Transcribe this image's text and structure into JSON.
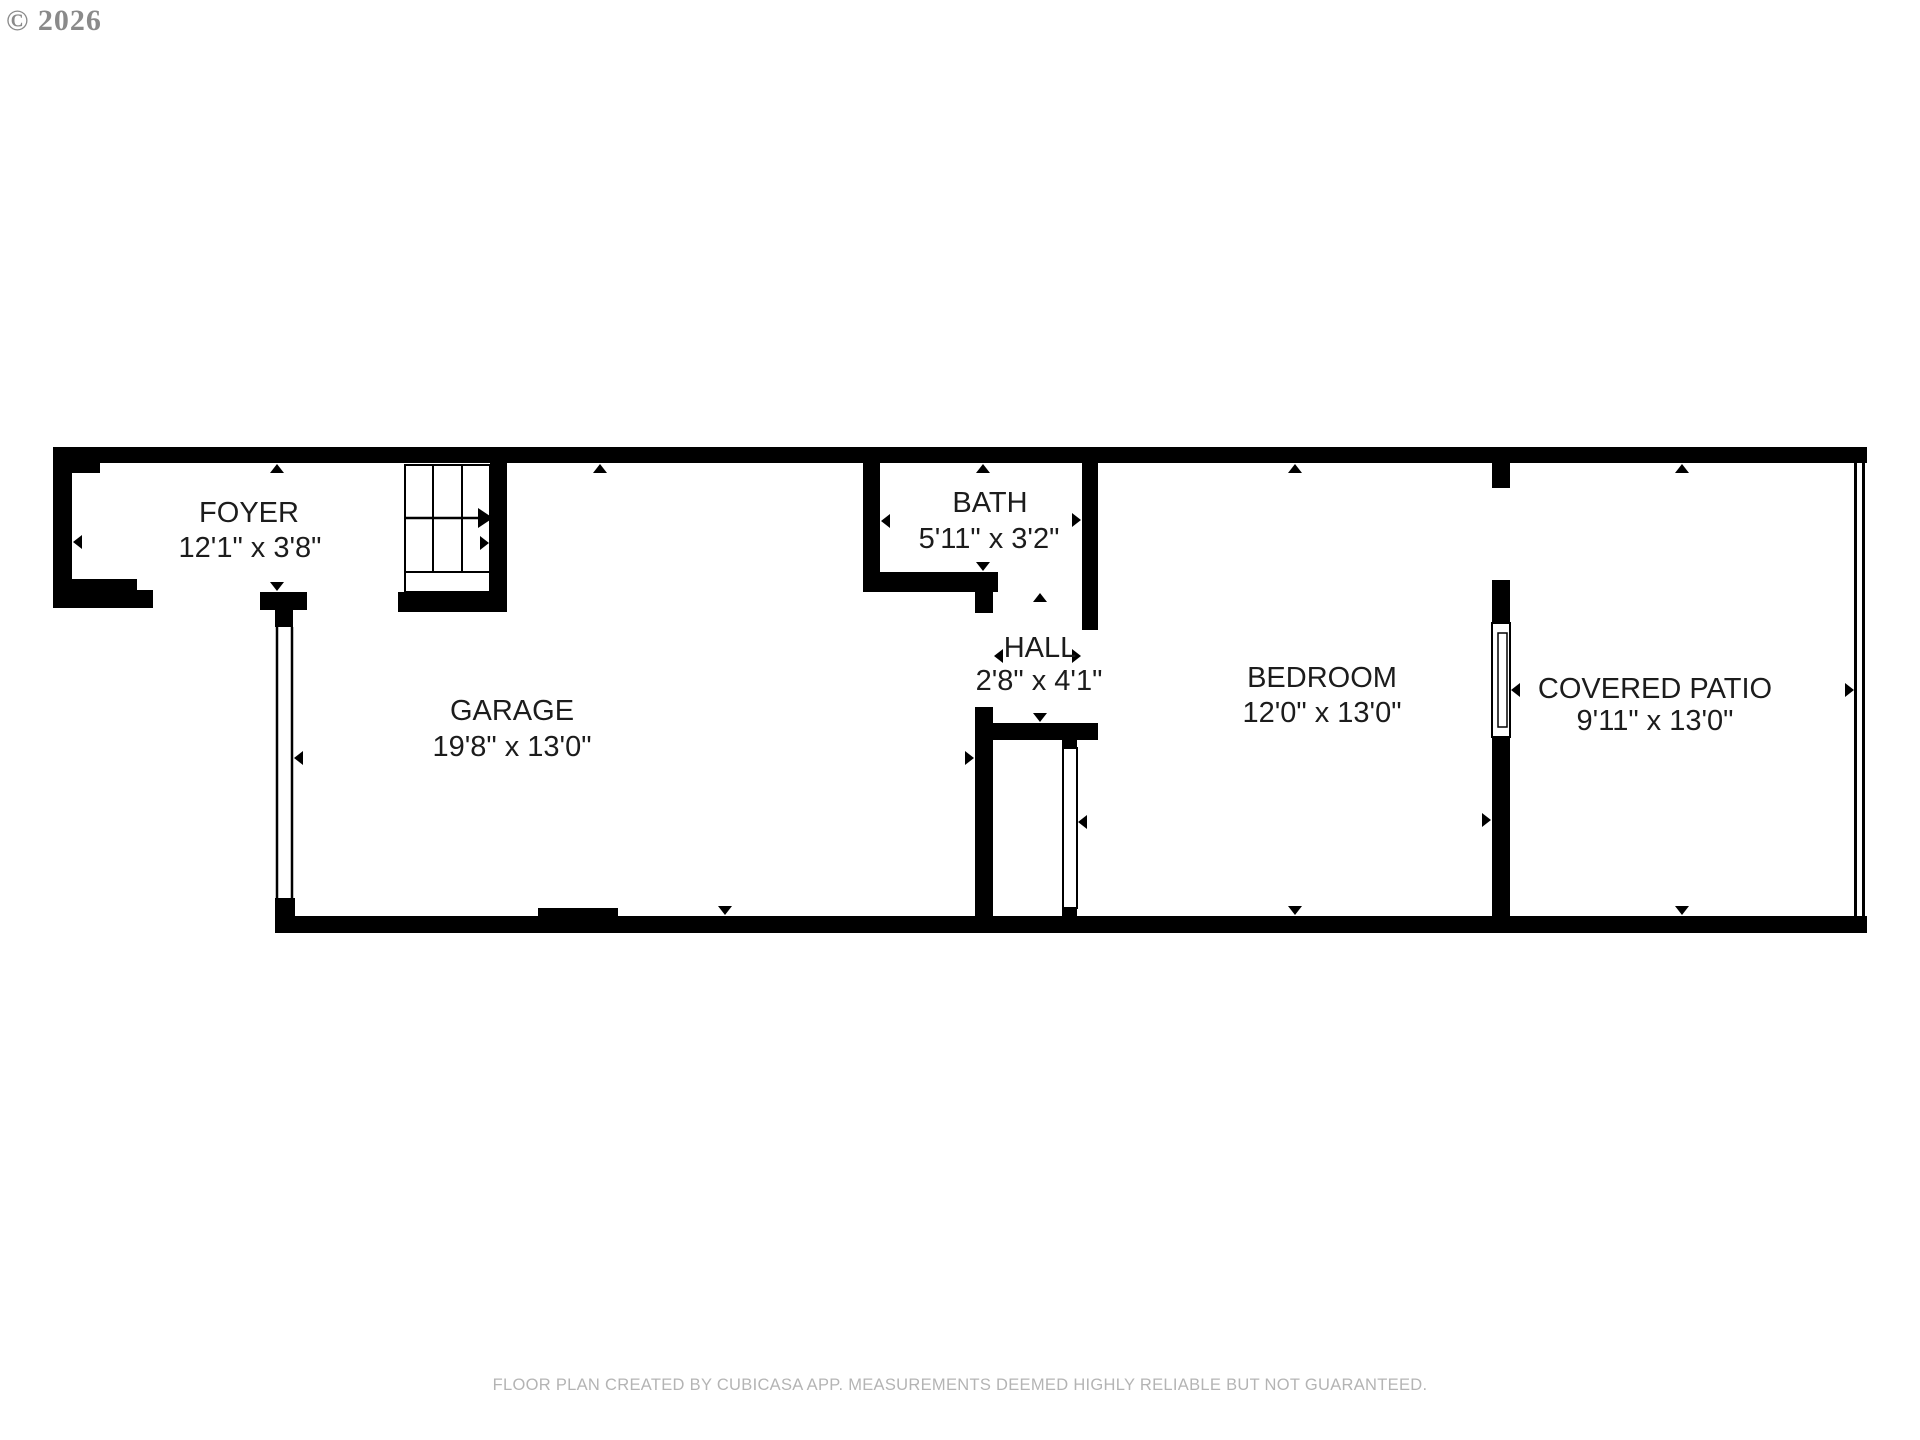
{
  "copyright": "© 2026",
  "footer": "FLOOR PLAN CREATED BY CUBICASA APP. MEASUREMENTS DEEMED HIGHLY RELIABLE BUT NOT GUARANTEED.",
  "rooms": {
    "foyer": {
      "name": "FOYER",
      "dimensions": "12'1\" x 3'8\""
    },
    "garage": {
      "name": "GARAGE",
      "dimensions": "19'8\" x 13'0\""
    },
    "bath": {
      "name": "BATH",
      "dimensions": "5'11\" x 3'2\""
    },
    "hall": {
      "name": "HALL",
      "dimensions": "2'8\" x 4'1\""
    },
    "bedroom": {
      "name": "BEDROOM",
      "dimensions": "12'0\" x 13'0\""
    },
    "covered_patio": {
      "name": "COVERED PATIO",
      "dimensions": "9'11\" x 13'0\""
    }
  },
  "colors": {
    "wall": "#000000",
    "room_text": "#1c1c1c",
    "copyright_text": "#8a8a8a",
    "footer_text": "#b4b4b4",
    "background": "#ffffff"
  }
}
